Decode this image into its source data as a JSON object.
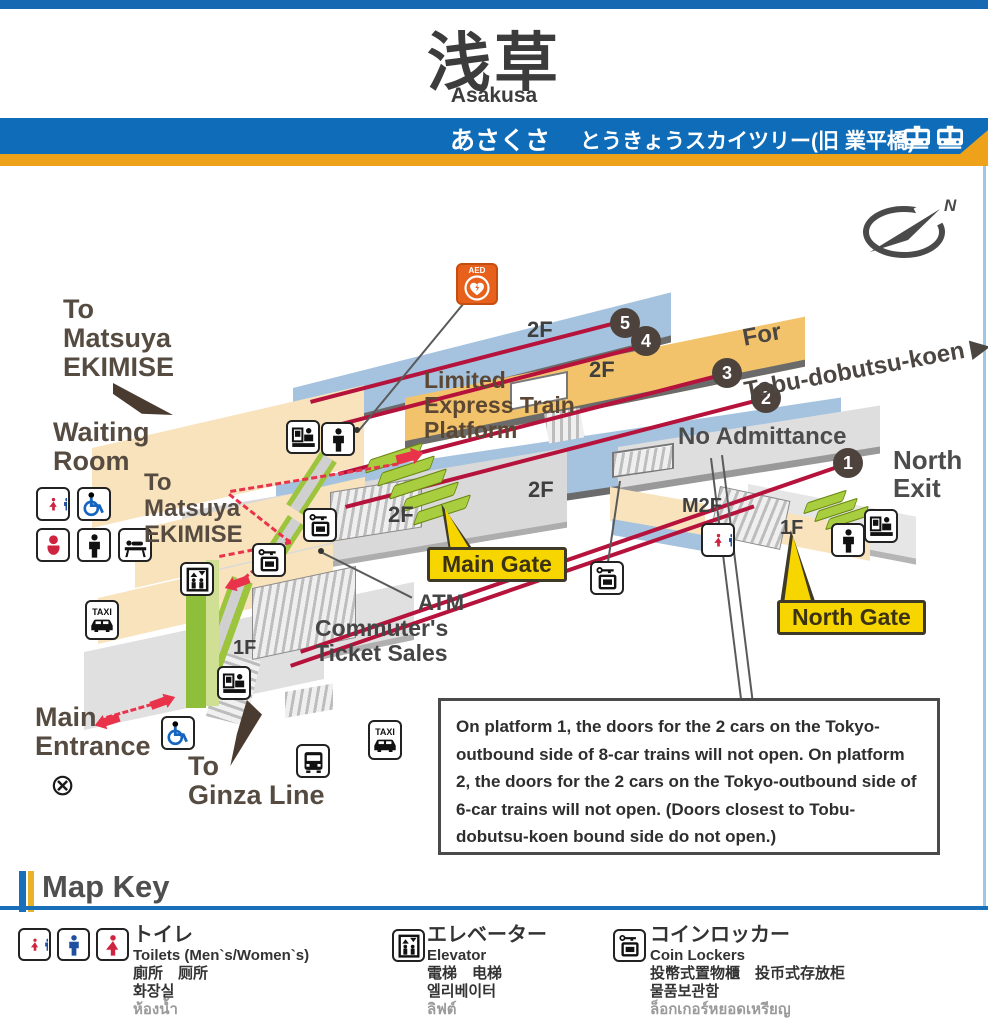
{
  "header": {
    "title_ja": "浅草",
    "title_en": "Asakusa",
    "hiragana": "あさくさ",
    "next_station": "とうきょうスカイツリー(旧 業平橋)"
  },
  "map": {
    "labels": {
      "to_matsuya_1": "To\nMatsuya\nEKIMISE",
      "waiting_room": "Waiting\nRoom",
      "to_matsuya_2": "To\nMatsuya\nEKIMISE",
      "limited_express": "Limited\nExpress Train\nPlatform",
      "direction_line1": "For",
      "direction_line2": "Tobu-dobutsu-koen ▶",
      "no_admittance": "No Admittance",
      "north_exit": "North\nExit",
      "m2f": "M2F",
      "f2": "2F",
      "f1": "1F",
      "main_gate": "Main Gate",
      "north_gate": "North Gate",
      "atm": "ATM",
      "commuters": "Commuter's\nTicket Sales",
      "main_entrance": "Main\nEntrance",
      "to_ginza": "To\nGinza Line",
      "taxi": "TAXI",
      "aed": "AED",
      "compass_n": "N",
      "crossing_symbol": "⊗"
    },
    "platform_numbers": [
      "1",
      "2",
      "3",
      "4",
      "5"
    ],
    "note": "On platform 1, the doors for the 2 cars on the Tokyo-outbound side of 8-car trains will not open. On platform 2, the doors for the 2 cars on the Tokyo-outbound side of 6-car trains will not open. (Doors closest to Tobu-dobutsu-koen bound side do not open.)"
  },
  "map_key": {
    "title": "Map Key",
    "items": [
      {
        "name": "toilets",
        "ja": "トイレ",
        "en": "Toilets (Men`s/Women`s)",
        "zh": "廁所　厕所",
        "ko": "화장실",
        "th": "ห้องน้ำ"
      },
      {
        "name": "elevator",
        "ja": "エレベーター",
        "en": "Elevator",
        "zh": "電梯　电梯",
        "ko": "엘리베이터",
        "th": "ลิฟต์"
      },
      {
        "name": "coin_lockers",
        "ja": "コインロッカー",
        "en": "Coin Lockers",
        "zh": "投幣式置物櫃　投币式存放柜",
        "ko": "물품보관함",
        "th": "ล็อกเกอร์หยอดเหรียญ"
      }
    ]
  },
  "colors": {
    "tobu_blue": "#0e6cb8",
    "amber_stripe": "#eda21a",
    "track_red": "#b5123c",
    "gate_green": "#a8cd3f",
    "callout_yellow": "#f7d600",
    "platform_blue": "#a5c3de",
    "platform_orange": "#f2c36b",
    "floor_tan": "#f8e3bd",
    "floor_gray": "#d9d9d9"
  }
}
